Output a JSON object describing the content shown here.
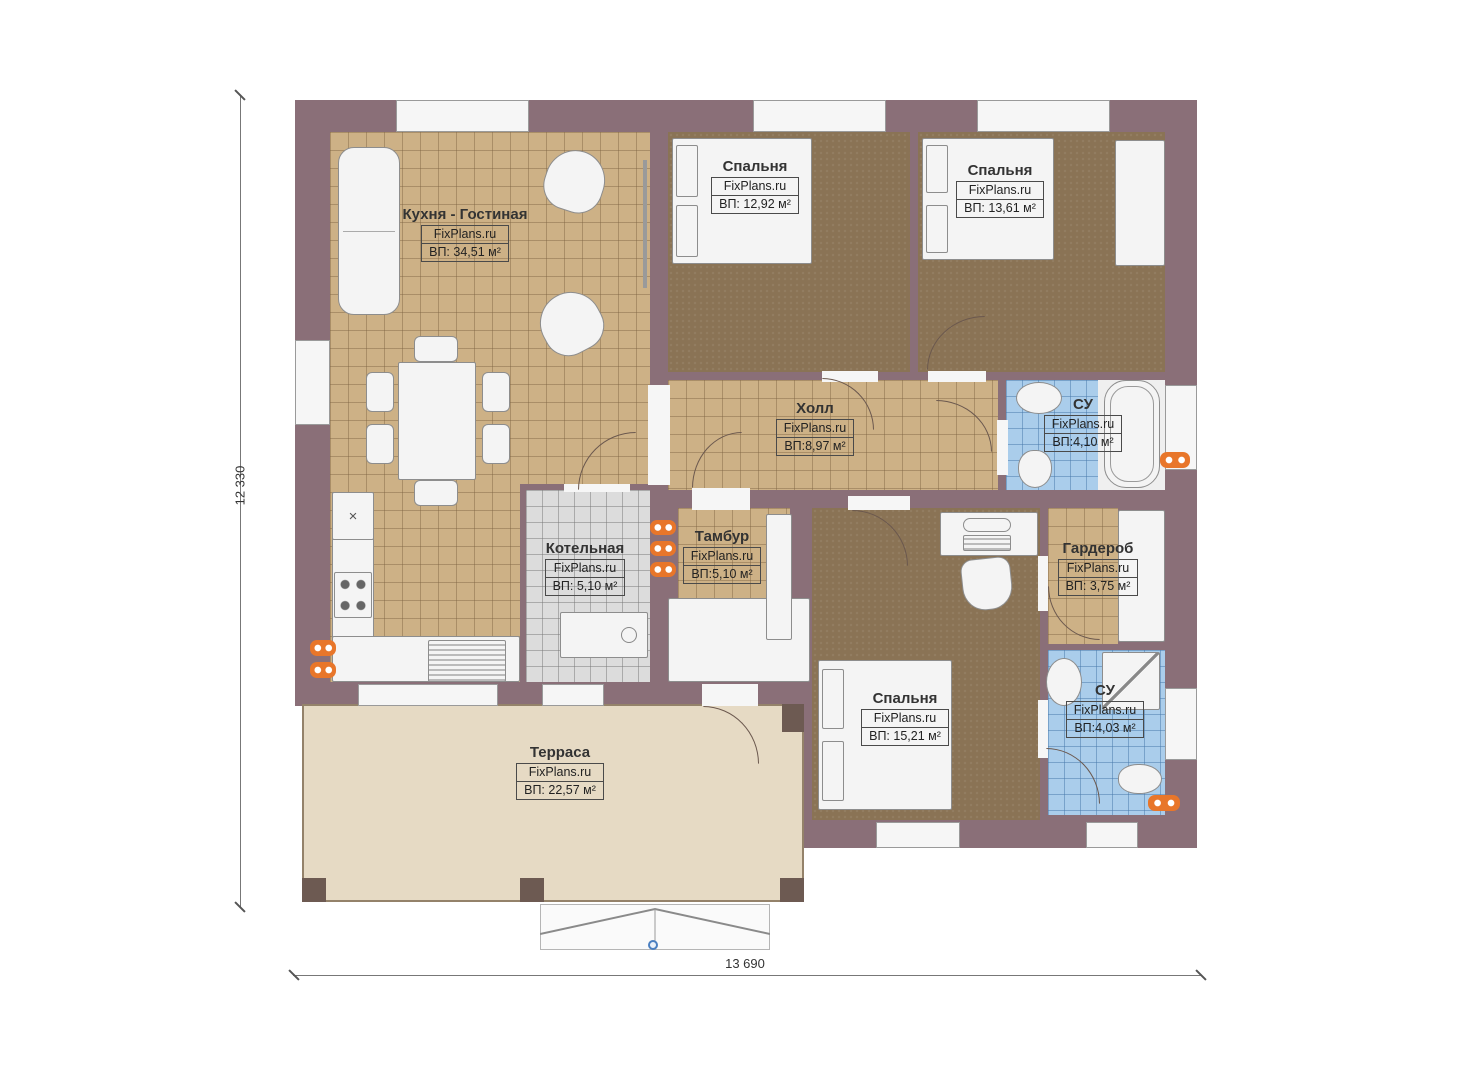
{
  "brand": "FixPlans.ru",
  "plan": {
    "type": "single-storey house floor plan",
    "dimensions": {
      "vertical": "12 330",
      "horizontal": "13 690"
    }
  },
  "rooms": [
    {
      "id": "kitchen-living",
      "name": "Кухня - Гостиная",
      "area": "ВП: 34,51 м²"
    },
    {
      "id": "bedroom-1",
      "name": "Спальня",
      "area": "ВП: 12,92 м²"
    },
    {
      "id": "bedroom-2",
      "name": "Спальня",
      "area": "ВП: 13,61 м²"
    },
    {
      "id": "hall",
      "name": "Холл",
      "area": "ВП:8,97 м²"
    },
    {
      "id": "bathroom-1",
      "name": "СУ",
      "area": "ВП:4,10 м²"
    },
    {
      "id": "boiler-room",
      "name": "Котельная",
      "area": "ВП: 5,10 м²"
    },
    {
      "id": "vestibule",
      "name": "Тамбур",
      "area": "ВП:5,10 м²"
    },
    {
      "id": "wardrobe",
      "name": "Гардероб",
      "area": "ВП: 3,75 м²"
    },
    {
      "id": "bedroom-3",
      "name": "Спальня",
      "area": "ВП: 15,21 м²"
    },
    {
      "id": "bathroom-2",
      "name": "СУ",
      "area": "ВП:4,03 м²"
    },
    {
      "id": "terrace",
      "name": "Терраса",
      "area": "ВП: 22,57 м²"
    }
  ],
  "icons": {
    "sink_cross": "×"
  },
  "colors": {
    "wall": "#8a6f78",
    "wall_post": "#6d5a52",
    "floor_tile": "#cdb186",
    "carpet": "#8a7355",
    "bath_tile": "#aacdeb",
    "boiler_tile": "#dcdcdc",
    "terrace_floor": "#e6dac4",
    "radiator": "#e8762a",
    "marker_blue": "#4a7fc1"
  }
}
